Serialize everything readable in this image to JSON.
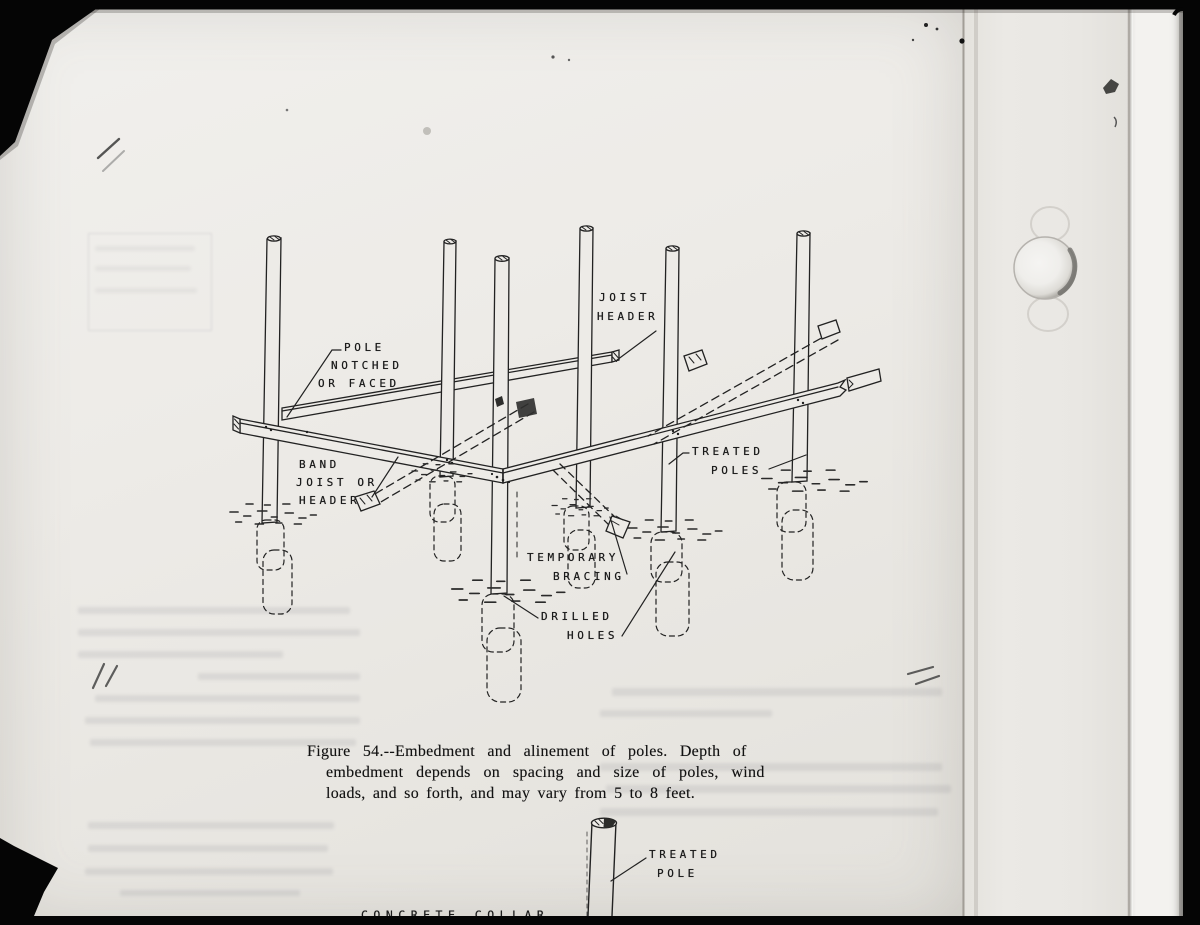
{
  "document": {
    "kind": "scanned manual page with figure",
    "figure_number": "Figure 54",
    "caption_lines": [
      "Figure 54.--Embedment and alinement of poles. Depth of",
      "embedment depends on spacing and size of poles, wind",
      "loads, and so forth, and may vary from 5 to 8 feet."
    ]
  },
  "diagram": {
    "title": "Embedment and alinement of poles",
    "labels": {
      "pole_notched": [
        "POLE",
        "NOTCHED",
        "OR FACED"
      ],
      "joist_header": [
        "JOIST",
        "HEADER"
      ],
      "band_joist": [
        "BAND",
        "JOIST OR",
        "HEADER"
      ],
      "treated_poles": [
        "TREATED",
        "POLES"
      ],
      "temporary_bracing": [
        "TEMPORARY",
        "BRACING"
      ],
      "drilled_holes": [
        "DRILLED",
        "HOLES"
      ]
    }
  },
  "bottom_diagram": {
    "labels": {
      "treated_pole": [
        "TREATED",
        "POLE"
      ],
      "concrete_collar": "CONCRETE COLLAR"
    }
  },
  "colors": {
    "paper": "#edebe7",
    "ink": "#222222",
    "photo_background": "#050505"
  }
}
